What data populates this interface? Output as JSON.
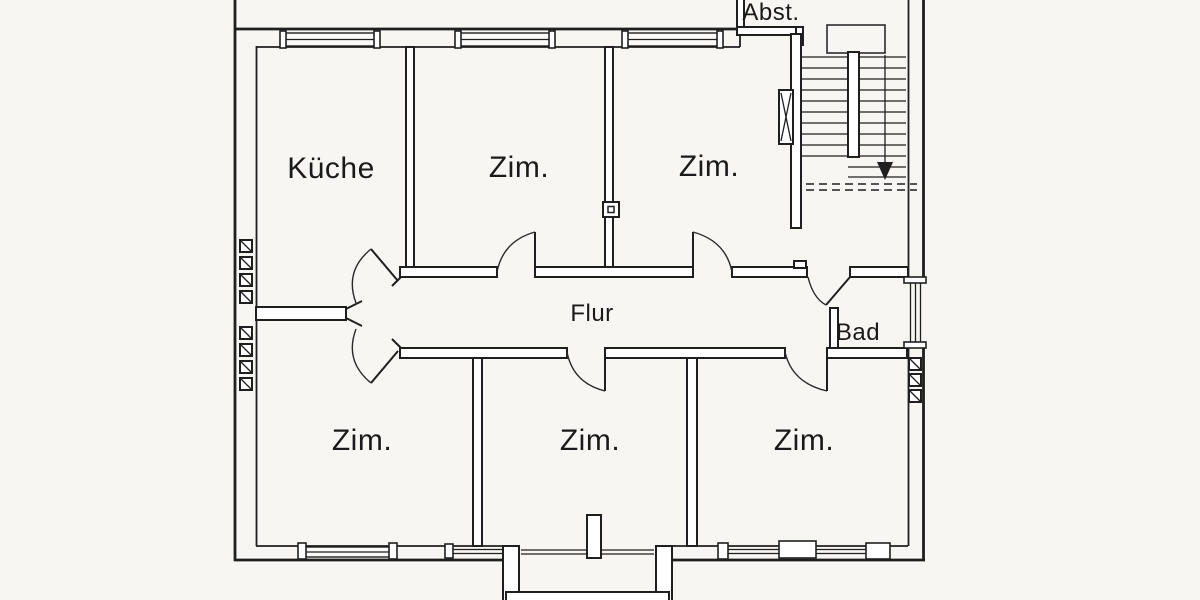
{
  "colors": {
    "background": "#f7f6f3",
    "line": "#1f1f1f",
    "text": "#1a1a1a"
  },
  "floor_plan": {
    "rooms": [
      {
        "id": "kueche",
        "label": "Küche"
      },
      {
        "id": "zimmer-top-middle",
        "label": "Zim."
      },
      {
        "id": "zimmer-top-right",
        "label": "Zim."
      },
      {
        "id": "abstellraum",
        "label": "Abst."
      },
      {
        "id": "flur",
        "label": "Flur"
      },
      {
        "id": "bad",
        "label": "Bad"
      },
      {
        "id": "zimmer-bottom-left",
        "label": "Zim."
      },
      {
        "id": "zimmer-bottom-middle",
        "label": "Zim."
      },
      {
        "id": "zimmer-bottom-right",
        "label": "Zim."
      }
    ],
    "icons": {
      "stair_direction": "stair-down-arrow-icon",
      "chimney_flue": "chimney-flue-icon",
      "entrance_door": "entrance-door-icon"
    }
  }
}
